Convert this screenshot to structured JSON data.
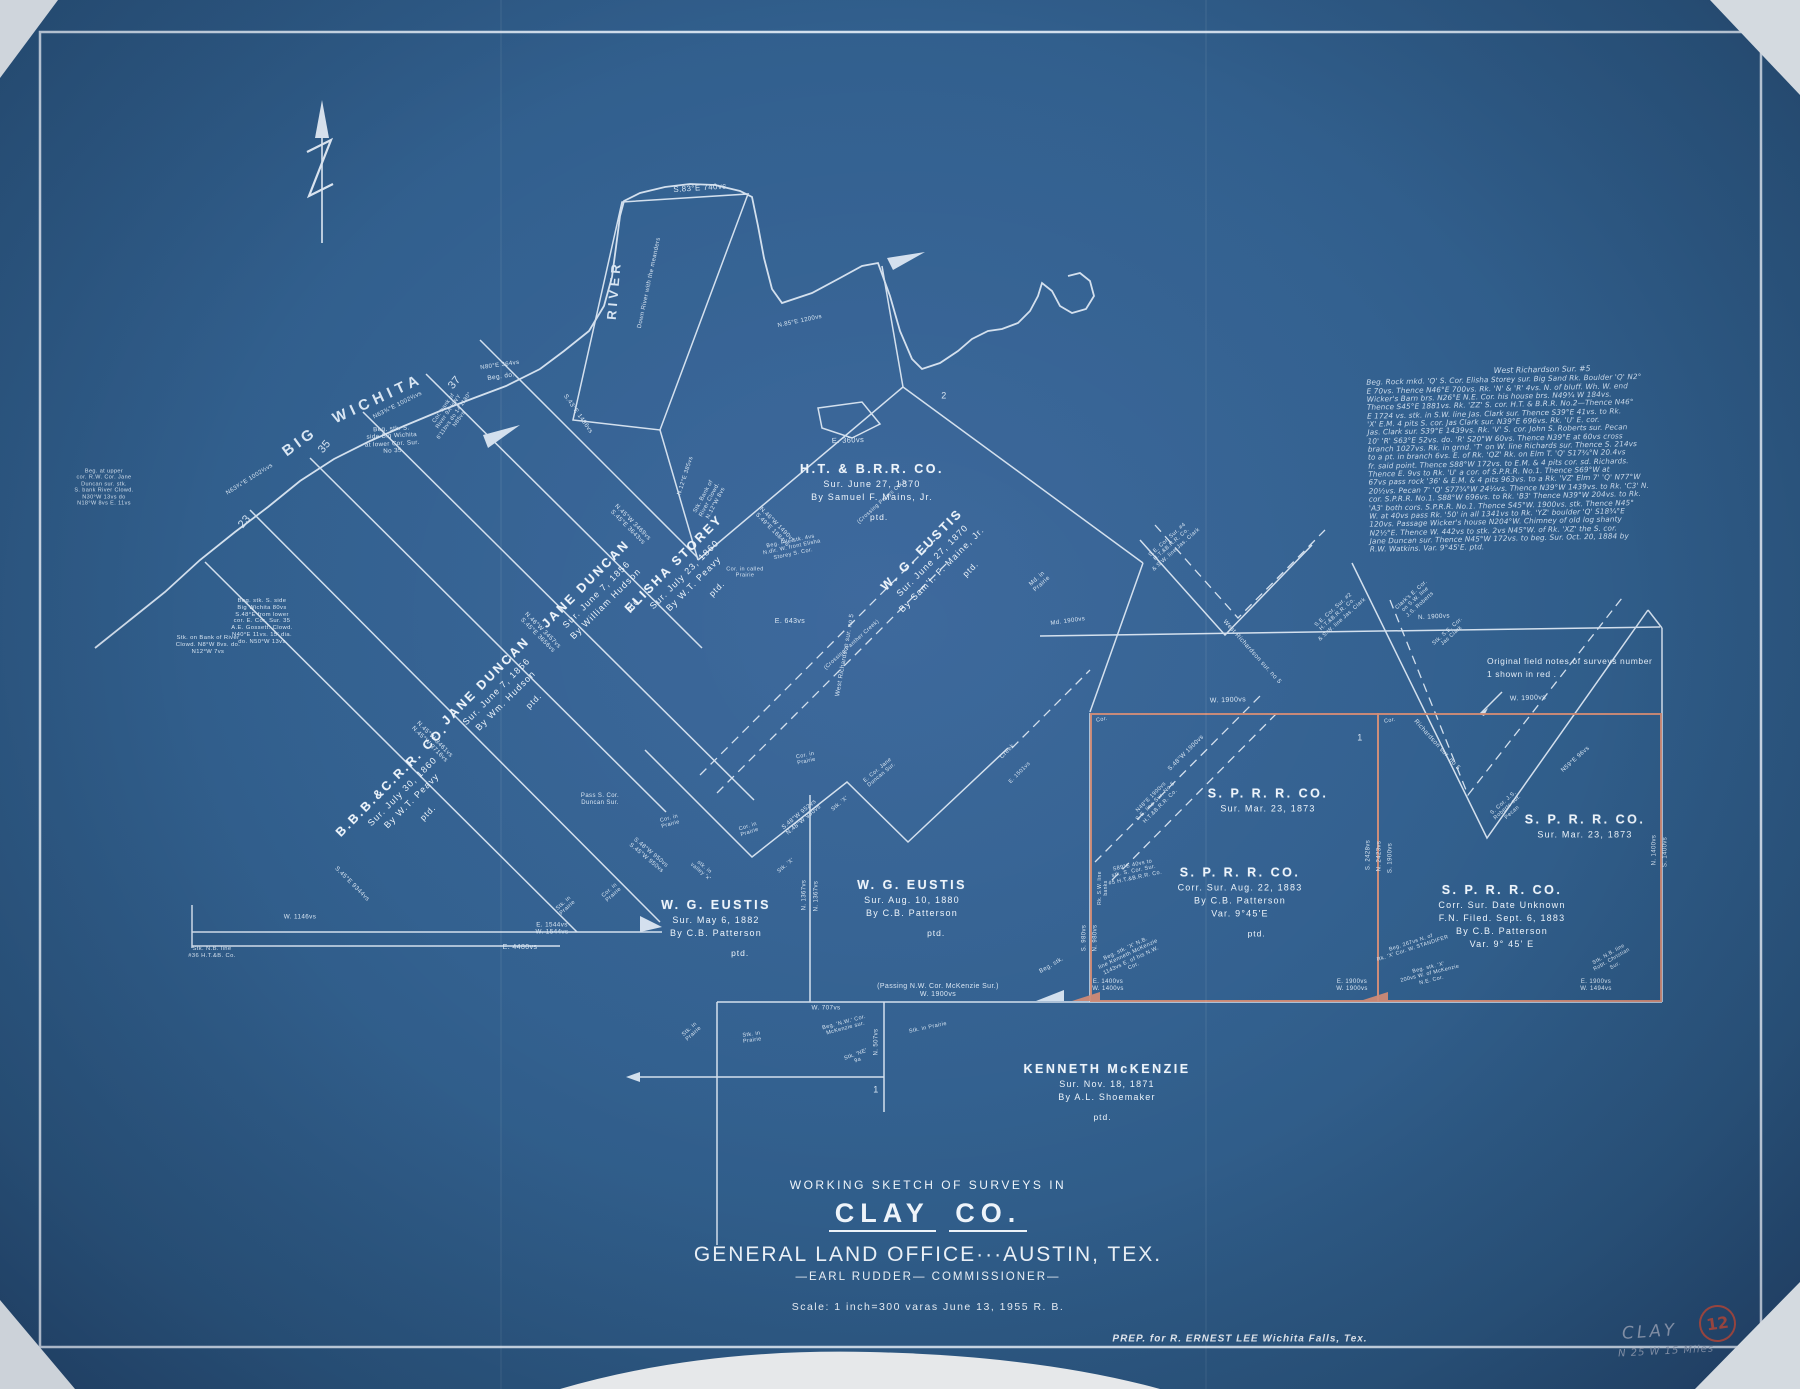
{
  "colors": {
    "line": "#e1ebf6",
    "red": "#cf8a75",
    "pencil": "#98a6bb",
    "bg": "#32608f"
  },
  "title_block": {
    "line1": "WORKING SKETCH OF SURVEYS IN",
    "county": "CLAY",
    "county2": "CO.",
    "office": "GENERAL LAND OFFICE···AUSTIN, TEX.",
    "commissioner": "—EARL RUDDER—  COMMISSIONER—",
    "scale": "Scale: 1 inch=300 varas    June 13, 1955    R. B."
  },
  "footer": {
    "prep": "PREP. for R. ERNEST LEE     Wichita Falls, Tex."
  },
  "margin_marks": {
    "county_pencil": "CLAY",
    "direction": "N 25 W    15 Miles",
    "sheet_number": "12"
  },
  "red_note": {
    "line1": "Original field notes of surveys number",
    "line2": "1  shown in red ."
  },
  "field_notes": {
    "title": "West Richardson Sur. #5",
    "lines": [
      "Beg. Rock mkd. 'Q' S. Cor. Elisha Storey sur. Big Sand Rk. Boulder 'Q' N2°",
      "E 70vs. Thence N46°E 700vs. Rk. 'N' & 'R' 4vs. N. of bluff. Wh. W. end",
      "Wicker's Barn brs. N26°E N.E. Cor. his house brs. N49¾ W 184vs.",
      "Thence S45°E 1881vs. Rk. 'ZZ' S. cor. H.T. & B.R.R. No.2—Thence N46°",
      "E 1724 vs. stk. in S.W. line Jas. Clark sur. Thence S39°E 41vs. to Rk.",
      "'X' E.M. 4 pits S. cor. Jas Clark sur. N39°E 696vs. Rk. 'U' E. cor.",
      "Jas. Clark sur. S39°E 1439vs. Rk. 'V' S. cor. John S. Roberts sur. Pecan",
      "10' 'R' S63°E 52vs. do. 'R' S20°W 60vs. Thence N39°E at 60vs cross",
      "branch 1027vs. Rk. in grnd. 'T' on W. line Richards sur. Thence S. 214vs",
      "to a pt. in branch 6vs. E. of Rk. 'QZ' Rk. on Elm T. 'Q' S17¾°N 20.4vs",
      "fr. said point. Thence S88°W 172vs. to E.M. & 4 pits cor. sd. Richards.",
      "Thence E. 9vs to Rk. 'U' a cor. of S.P.R.R. No.1. Thence S69°W at",
      "67vs pass rock '36' & E.M. & 4 pits 963vs. to a Rk. 'VZ' Elm 7' 'Q' N77°W",
      "20½vs. Pecan 7' 'Q' S77¾°W 24½vs. Thence N39°W 1439vs. to Rk. 'C3' N.",
      "cor. S.P.R.R. No.1. S88°W 696vs. to Rk. 'B3' Thence N39°W 204vs. to Rk.",
      "'A3' both cors. S.P.R.R. No.1. Thence S45°W. 1900vs. stk. Thence N45°",
      "W. at 40vs pass Rk. '50' in all 1341vs to Rk. 'YZ' boulder 'Q' S18¾°E",
      "120vs. Passage Wicker's house N204°W. Chimney of old log shanty",
      "N2½°E. Thence W. 442vs to stk. 2vs N45°W. of Rk. 'XZ' the S. cor.",
      "Jane Duncan sur. Thence N45°W 172vs. to beg. Sur. Oct. 20, 1884 by",
      "R.W. Watkins. Var. 9°45'E.  ptd."
    ]
  },
  "survey_labels": [
    {
      "name": "JANE  DUNCAN",
      "lines": [
        "Sur. June 7, 1856",
        "By William Hudson"
      ],
      "ptd": "ptd.",
      "x": 602,
      "y": 600,
      "r": -45
    },
    {
      "name": "JANE  DUNCAN",
      "lines": [
        "Sur. June 7, 1856",
        "By Wm. Hudson"
      ],
      "ptd": "ptd.",
      "x": 502,
      "y": 697,
      "r": -45
    },
    {
      "name": "B.B.B.&C.R.R. CO.",
      "lines": [
        "Sur. July 30, 1860",
        "By W.T. Peavy"
      ],
      "ptd": "ptd.",
      "x": 408,
      "y": 797,
      "r": -45
    },
    {
      "name": "ELISHA  STOREY",
      "lines": [
        "Sur. July 23, 1860",
        "By W.T. Peavy"
      ],
      "ptd": "ptd.",
      "x": 690,
      "y": 580,
      "r": -45
    },
    {
      "name": "H.T. & B.R.R. CO.",
      "lines": [
        "Sur. June 27, 1870",
        "By Samuel F. Mains, Jr."
      ],
      "ptd": "ptd.",
      "x": 872,
      "y": 492,
      "r": 0
    },
    {
      "name": "W. G. EUSTIS",
      "lines": [
        "Sur. June 27, 1870",
        "By Sam'l. F. Maine, Jr."
      ],
      "ptd": "ptd.",
      "x": 938,
      "y": 566,
      "r": -45
    },
    {
      "name": "W. G. EUSTIS",
      "lines": [
        "Sur. May 6, 1882",
        "By C.B. Patterson"
      ],
      "ptd": "ptd.",
      "x": 716,
      "y": 928,
      "r": 0
    },
    {
      "name": "W. G. EUSTIS",
      "lines": [
        "Sur. Aug. 10, 1880",
        "By C.B. Patterson"
      ],
      "ptd": "ptd.",
      "x": 912,
      "y": 908,
      "r": 0
    },
    {
      "name": "S. P. R. R. CO.",
      "lines": [
        "Sur. Mar. 23, 1873"
      ],
      "ptd": "",
      "x": 1268,
      "y": 800,
      "r": 0
    },
    {
      "name": "S. P. R. R. CO.",
      "lines": [
        "Corr. Sur. Aug. 22, 1883",
        "By C.B. Patterson",
        "Var. 9°45'E"
      ],
      "ptd": "ptd.",
      "x": 1240,
      "y": 902,
      "r": 0
    },
    {
      "name": "S. P. R. R. CO.",
      "lines": [
        "Sur. Mar. 23, 1873"
      ],
      "ptd": "",
      "x": 1585,
      "y": 826,
      "r": 0
    },
    {
      "name": "S. P. R. R. CO.",
      "lines": [
        "Corr. Sur. Date Unknown",
        "F.N. Filed. Sept. 6, 1883",
        "By C.B. Patterson",
        "Var. 9° 45' E"
      ],
      "ptd": "",
      "x": 1502,
      "y": 916,
      "r": 0
    },
    {
      "name": "KENNETH  McKENZIE",
      "lines": [
        "Sur. Nov. 18, 1871",
        "By A.L. Shoemaker"
      ],
      "ptd": "ptd.",
      "x": 1107,
      "y": 1092,
      "r": 0
    }
  ],
  "annotations": [
    {
      "t": "S.83°E 740vs",
      "x": 700,
      "y": 188,
      "r": -4,
      "s": 8
    },
    {
      "t": "E. 360vs",
      "x": 848,
      "y": 441,
      "r": -2,
      "s": 7.5
    },
    {
      "t": "BIG",
      "x": 300,
      "y": 442,
      "r": -36,
      "s": 15,
      "ls": 4,
      "b": 1
    },
    {
      "t": "WICHITA",
      "x": 378,
      "y": 399,
      "r": -25,
      "s": 15,
      "ls": 5,
      "b": 1
    },
    {
      "t": "RIVER",
      "x": 614,
      "y": 290,
      "r": -85,
      "s": 13,
      "ls": 4,
      "b": 1
    },
    {
      "t": "Down River with the meanders",
      "x": 650,
      "y": 283,
      "r": -78,
      "s": 6
    },
    {
      "t": "23",
      "x": 245,
      "y": 522,
      "r": -50,
      "s": 11
    },
    {
      "t": "35",
      "x": 325,
      "y": 447,
      "r": -50,
      "s": 11
    },
    {
      "t": "37",
      "x": 455,
      "y": 383,
      "r": -50,
      "s": 11
    },
    {
      "t": "2",
      "x": 944,
      "y": 396,
      "r": 0,
      "s": 9
    },
    {
      "t": "1",
      "x": 1360,
      "y": 738,
      "r": 0,
      "s": 9
    },
    {
      "t": "1",
      "x": 876,
      "y": 1090,
      "r": 0,
      "s": 9
    },
    {
      "t": "N63¾°E 1002½vs",
      "x": 398,
      "y": 406,
      "r": -27,
      "s": 6
    },
    {
      "t": "N63¾°E 1002½vs",
      "x": 250,
      "y": 480,
      "r": -32,
      "s": 6
    },
    {
      "t": "Beg. stk. S.\nside Big Wichita\nat lower Cor. Sur.\nNo 35",
      "x": 392,
      "y": 440,
      "r": -3,
      "s": 6.2
    },
    {
      "t": "N80°E 364vs",
      "x": 500,
      "y": 366,
      "r": -8,
      "s": 6
    },
    {
      "t": "Beg. do.",
      "x": 501,
      "y": 377,
      "r": -8,
      "s": 6.5
    },
    {
      "t": "Cor. bank of\nRiver 9A HWY\n6'11bvs do 14'1180°\nN85vs",
      "x": 452,
      "y": 414,
      "r": -55,
      "s": 5.5
    },
    {
      "t": "S.43°E 1496vs",
      "x": 578,
      "y": 414,
      "r": 55,
      "s": 6.2
    },
    {
      "t": "N.85°E 1200vs",
      "x": 800,
      "y": 322,
      "r": -12,
      "s": 6
    },
    {
      "t": "Beg. stk. S. side\nBig Wichita 80vs\nS.48°E from lower\ncor. E. Cor. Sur. 35\nA.E. Gossett. Clowd.\nN40°E 11vs. 15' dia.\ndo. N50°W 13vs",
      "x": 262,
      "y": 622,
      "r": 0,
      "s": 5.8
    },
    {
      "t": "Beg. at upper\ncor. R.W. Cor. Jane\nDuncan sur. stk.\nS. bank River Clowd.\nN30°W 13vs do\nN18°W 8vs E. 11vs",
      "x": 104,
      "y": 488,
      "r": 0,
      "s": 5.5
    },
    {
      "t": "Stk. on Bank of River\nClowd. N8°W 8vs. do.\nN12°W 7vs",
      "x": 208,
      "y": 645,
      "r": 0,
      "s": 5.8
    },
    {
      "t": "Stk. Bank of\nRiver Clowd.\nN.12°W 8vs",
      "x": 710,
      "y": 500,
      "r": -62,
      "s": 5.8
    },
    {
      "t": "N.12°E 385vs",
      "x": 686,
      "y": 476,
      "r": -72,
      "s": 5.8
    },
    {
      "t": "N.46°W 1490vs\nS.49°E 1684vs",
      "x": 774,
      "y": 528,
      "r": 45,
      "s": 6
    },
    {
      "t": "N.45°W 3469vs\nS.45°E 3643vs",
      "x": 630,
      "y": 525,
      "r": 45,
      "s": 6.2
    },
    {
      "t": "N.46°W 3457vs\nS.45°E 3656vs",
      "x": 540,
      "y": 633,
      "r": 45,
      "s": 6.2
    },
    {
      "t": "N.45°W 3461vs\nN.45°W 3716vs",
      "x": 432,
      "y": 742,
      "r": 45,
      "s": 6.2
    },
    {
      "t": "S.45°E 9344vs",
      "x": 352,
      "y": 884,
      "r": 45,
      "s": 6.2
    },
    {
      "t": "S.48°W 950vs\nS.45°W 950vs",
      "x": 648,
      "y": 856,
      "r": 40,
      "s": 6
    },
    {
      "t": "stk. in\nvalley 'x'",
      "x": 702,
      "y": 870,
      "r": 40,
      "s": 5.5
    },
    {
      "t": "S.48°W 952vs\nN.48°W 950vs",
      "x": 802,
      "y": 818,
      "r": -40,
      "s": 6
    },
    {
      "t": "Stk. 'X'",
      "x": 840,
      "y": 804,
      "r": -40,
      "s": 5.5
    },
    {
      "t": "Stk. 'X'",
      "x": 786,
      "y": 866,
      "r": -40,
      "s": 5.5
    },
    {
      "t": "E. Cor. Jane\nDuncan Sur.",
      "x": 880,
      "y": 773,
      "r": -40,
      "s": 5.5
    },
    {
      "t": "Cor. in\nPrairie",
      "x": 612,
      "y": 893,
      "r": -42,
      "s": 5.5
    },
    {
      "t": "Cor. in\nPrairie",
      "x": 670,
      "y": 822,
      "r": -15,
      "s": 5.5
    },
    {
      "t": "Cor. in\nPrairie",
      "x": 749,
      "y": 830,
      "r": -18,
      "s": 5.5
    },
    {
      "t": "Cor. in\nPrairie",
      "x": 806,
      "y": 759,
      "r": -12,
      "s": 5.5
    },
    {
      "t": "Pass S. Cor.\nDuncan Sur.",
      "x": 600,
      "y": 800,
      "r": 0,
      "s": 6
    },
    {
      "t": "Cor. in called\nPrairie",
      "x": 745,
      "y": 573,
      "r": 0,
      "s": 5.5
    },
    {
      "t": "Beg. File stk. 4vs\nN.dir. W. front Elisha\nStorey S. Cor.",
      "x": 792,
      "y": 548,
      "r": -12,
      "s": 5.5
    },
    {
      "t": "(Crossing Perrys Crk.)",
      "x": 882,
      "y": 502,
      "r": -42,
      "s": 5.5
    },
    {
      "t": "(Crossing Panther Creek)",
      "x": 852,
      "y": 645,
      "r": -42,
      "s": 5.5
    },
    {
      "t": "E. 643vs",
      "x": 790,
      "y": 622,
      "r": 0,
      "s": 7
    },
    {
      "t": "West Richardson sur. no 5",
      "x": 845,
      "y": 655,
      "r": -80,
      "s": 6.3
    },
    {
      "t": "West Richardson sur. no 5",
      "x": 1252,
      "y": 652,
      "r": 48,
      "s": 6.3
    },
    {
      "t": "Richardson sur. no 5",
      "x": 1437,
      "y": 745,
      "r": 48,
      "s": 6.3
    },
    {
      "t": "S.48°W 1900vs",
      "x": 1186,
      "y": 753,
      "r": -45,
      "s": 6.2
    },
    {
      "t": "N48°E 1900vs\nS.E. line Sur. No 5\nH.T.&B.R.R. Co.",
      "x": 1156,
      "y": 802,
      "r": -45,
      "s": 5.5
    },
    {
      "t": "Creek",
      "x": 1008,
      "y": 752,
      "r": -45,
      "s": 6
    },
    {
      "t": "E. 1501vs",
      "x": 1020,
      "y": 773,
      "r": -45,
      "s": 5.5
    },
    {
      "t": "Md. in\nPrairie",
      "x": 1040,
      "y": 582,
      "r": -42,
      "s": 6
    },
    {
      "t": "Md. 1900vs",
      "x": 1068,
      "y": 622,
      "r": -8,
      "s": 6
    },
    {
      "t": "N. 1900vs",
      "x": 1434,
      "y": 617,
      "r": -3,
      "s": 6.3
    },
    {
      "t": "W. 1900vs",
      "x": 1228,
      "y": 701,
      "r": -2,
      "s": 7
    },
    {
      "t": "W. 1900vs",
      "x": 1528,
      "y": 699,
      "r": -2,
      "s": 7
    },
    {
      "t": "Cor.",
      "x": 1102,
      "y": 720,
      "r": -10,
      "s": 5.5
    },
    {
      "t": "Cor.",
      "x": 1390,
      "y": 721,
      "r": -10,
      "s": 5.5
    },
    {
      "t": "S.E. Cor. Sur. #4\nH.T.&B.R.R. Co.\n& S.W. line Jas. Clark",
      "x": 1172,
      "y": 545,
      "r": -42,
      "s": 5.5
    },
    {
      "t": "S.E. Cor. Sur. #2\nH.T.&B.R.R. Co.\n& S.W. line Jas. Clark",
      "x": 1338,
      "y": 615,
      "r": -42,
      "s": 5.5
    },
    {
      "t": "Clark's E. Cor.\non S.W. line\nJ.S. Roberts",
      "x": 1416,
      "y": 600,
      "r": -42,
      "s": 5.5
    },
    {
      "t": "Stk. S.E. Cor.\nJas Clark",
      "x": 1450,
      "y": 634,
      "r": -42,
      "s": 5.5
    },
    {
      "t": "S. Cor. J.S.\nRoberts sur.\nPecan",
      "x": 1508,
      "y": 808,
      "r": -42,
      "s": 5.5
    },
    {
      "t": "N59°E 96vs",
      "x": 1576,
      "y": 760,
      "r": -42,
      "s": 6
    },
    {
      "t": "S. 2428vs",
      "x": 1369,
      "y": 855,
      "r": -90,
      "s": 6
    },
    {
      "t": "N. 2423vs",
      "x": 1380,
      "y": 856,
      "r": -90,
      "s": 6
    },
    {
      "t": "S. 1900vs",
      "x": 1391,
      "y": 858,
      "r": -90,
      "s": 6
    },
    {
      "t": "N. 1400vs",
      "x": 1655,
      "y": 850,
      "r": -90,
      "s": 6
    },
    {
      "t": "S. 1400vs",
      "x": 1666,
      "y": 852,
      "r": -90,
      "s": 6
    },
    {
      "t": "S. 980vs",
      "x": 1085,
      "y": 938,
      "r": -90,
      "s": 6
    },
    {
      "t": "N. 980vs",
      "x": 1096,
      "y": 938,
      "r": -90,
      "s": 6
    },
    {
      "t": "Rk. S.W. line\nbanks",
      "x": 1104,
      "y": 888,
      "r": -90,
      "s": 5
    },
    {
      "t": "N. 1367vs",
      "x": 805,
      "y": 895,
      "r": -90,
      "s": 6
    },
    {
      "t": "N. 1367vs",
      "x": 817,
      "y": 896,
      "r": -90,
      "s": 6
    },
    {
      "t": "N. 507vs",
      "x": 877,
      "y": 1042,
      "r": -90,
      "s": 6
    },
    {
      "t": "S89°E 40vs to\nstk. S. Cor. Sur.\n#5 H.T.&B.R.R. Co.",
      "x": 1134,
      "y": 872,
      "r": -12,
      "s": 5.5
    },
    {
      "t": "Beg. stk. 'X' N.B.\nline Kenneth McKenzie\n1143vs E. of his N.W.\nCor.",
      "x": 1130,
      "y": 958,
      "r": -25,
      "s": 5.5
    },
    {
      "t": "Beg. stk.",
      "x": 1052,
      "y": 966,
      "r": -30,
      "s": 6
    },
    {
      "t": "(Passing N.W. Cor. McKenzie Sur.)\nW. 1900vs",
      "x": 938,
      "y": 991,
      "r": 0,
      "s": 7
    },
    {
      "t": "W. 707vs",
      "x": 826,
      "y": 1008,
      "r": 0,
      "s": 6.3
    },
    {
      "t": "Stk. in\nPrairie",
      "x": 692,
      "y": 1032,
      "r": -42,
      "s": 5.5
    },
    {
      "t": "Beg. 'N.W.' Cor.\nMcKenzie sur.",
      "x": 845,
      "y": 1026,
      "r": -15,
      "s": 5.5
    },
    {
      "t": "Stk. 'NE'\n9a",
      "x": 857,
      "y": 1058,
      "r": -20,
      "s": 5.5
    },
    {
      "t": "Stk. in Prairie",
      "x": 928,
      "y": 1028,
      "r": -12,
      "s": 5.5
    },
    {
      "t": "Stk. in\nPrairie",
      "x": 566,
      "y": 906,
      "r": -42,
      "s": 5.5
    },
    {
      "t": "Stk. in\nPrairie",
      "x": 752,
      "y": 1038,
      "r": -8,
      "s": 5.5
    },
    {
      "t": "E. 1400vs\nW. 1400vs",
      "x": 1108,
      "y": 986,
      "r": 0,
      "s": 6
    },
    {
      "t": "E. 1900vs\nW. 1900vs",
      "x": 1352,
      "y": 986,
      "r": 0,
      "s": 6
    },
    {
      "t": "E. 1900vs\nW. 1494vs",
      "x": 1596,
      "y": 986,
      "r": 0,
      "s": 6
    },
    {
      "t": "Beg. 267vs N. of\nRk. 'X' Cor. W. STANDIFER",
      "x": 1412,
      "y": 946,
      "r": -18,
      "s": 5.3
    },
    {
      "t": "Beg. stk. 'X'\n200vs W. of McKenzie\nN.E. Cor.",
      "x": 1430,
      "y": 974,
      "r": -14,
      "s": 5.3
    },
    {
      "t": "Stk. N.B. line\nRobt. Christian\nSur.",
      "x": 1612,
      "y": 960,
      "r": -30,
      "s": 5.3
    },
    {
      "t": "W. 1146vs",
      "x": 300,
      "y": 917,
      "r": 0,
      "s": 6.3
    },
    {
      "t": "E. 1544vs\nW. 1544vs",
      "x": 552,
      "y": 929,
      "r": 0,
      "s": 6.3
    },
    {
      "t": "E. 4480vs",
      "x": 520,
      "y": 948,
      "r": 0,
      "s": 7
    },
    {
      "t": "Stk. N.B. line\n#36 H.T.&B. Co.",
      "x": 212,
      "y": 953,
      "r": 0,
      "s": 5.8
    }
  ]
}
